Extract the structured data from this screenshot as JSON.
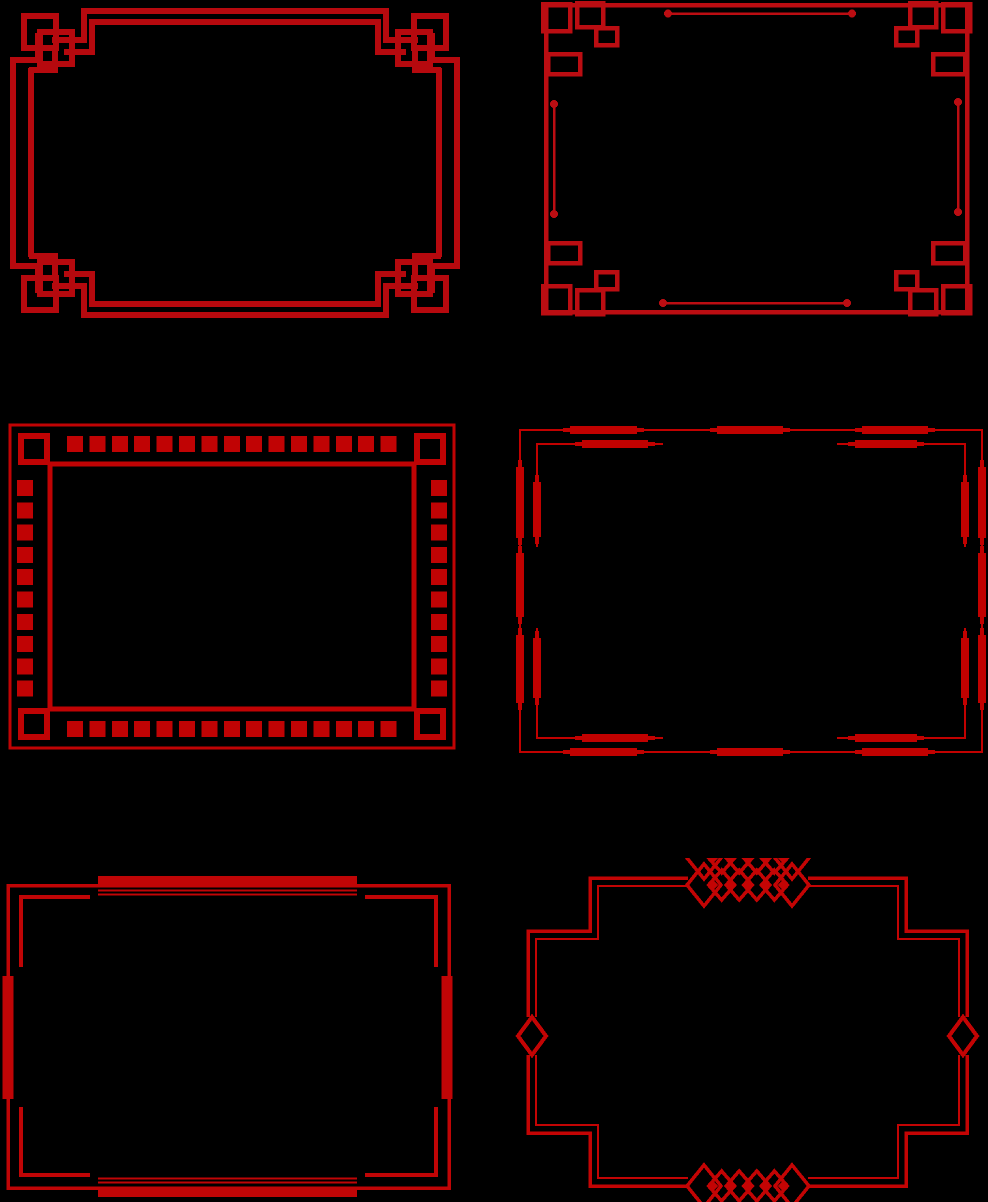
{
  "canvas": {
    "width": 988,
    "height": 1202,
    "background": "#000000",
    "description": "Six ornamental Chinese-style red border frames on a black background, arranged in two columns and three rows. No text content is present in the image."
  },
  "palette": {
    "background": "#000000",
    "red_dark": "#B6090E",
    "red_mid": "#BB0D12",
    "red_bright": "#C30404"
  },
  "frames": [
    {
      "id": "frame-1",
      "name": "interlocked-knot-border",
      "style": "double-line rectangle with woven interlocked square knots at each corner",
      "color": "#B6090E",
      "position": {
        "x": 0,
        "y": 0,
        "width": 470,
        "height": 326
      }
    },
    {
      "id": "frame-2",
      "name": "square-cluster-border",
      "style": "single-line rectangle with clusters of overlapping open squares at corners and dot-tipped accent lines on each edge",
      "color": "#BB0D12",
      "position": {
        "x": 515,
        "y": 0,
        "width": 473,
        "height": 330
      }
    },
    {
      "id": "frame-3",
      "name": "filled-square-band-border",
      "style": "thin outer rectangle and thick inner rectangle with a band of small filled squares between them and hollow squares at corners",
      "color": "#C00304",
      "position": {
        "x": 2,
        "y": 418,
        "width": 460,
        "height": 337
      }
    },
    {
      "id": "frame-4",
      "name": "spindle-bar-border",
      "style": "double thin rectangle decorated with thick tapered bar segments along outer and inner lines, inner line broken at edge centers",
      "color": "#C10100",
      "position": {
        "x": 515,
        "y": 420,
        "width": 473,
        "height": 340
      }
    },
    {
      "id": "frame-5",
      "name": "mid-bar-bracket-border",
      "style": "thin rectangle with thick bars at the middle of each edge, flanking thin lines, and inner corner brackets",
      "color": "#C00506",
      "position": {
        "x": 0,
        "y": 860,
        "width": 455,
        "height": 342
      }
    },
    {
      "id": "frame-6",
      "name": "stepped-diamond-border",
      "style": "stepped octagonal double-line frame with chains of linked diamonds at top and bottom centers and single diamonds at left and right edge centers",
      "color": "#C30404",
      "position": {
        "x": 505,
        "y": 858,
        "width": 478,
        "height": 344
      }
    }
  ]
}
